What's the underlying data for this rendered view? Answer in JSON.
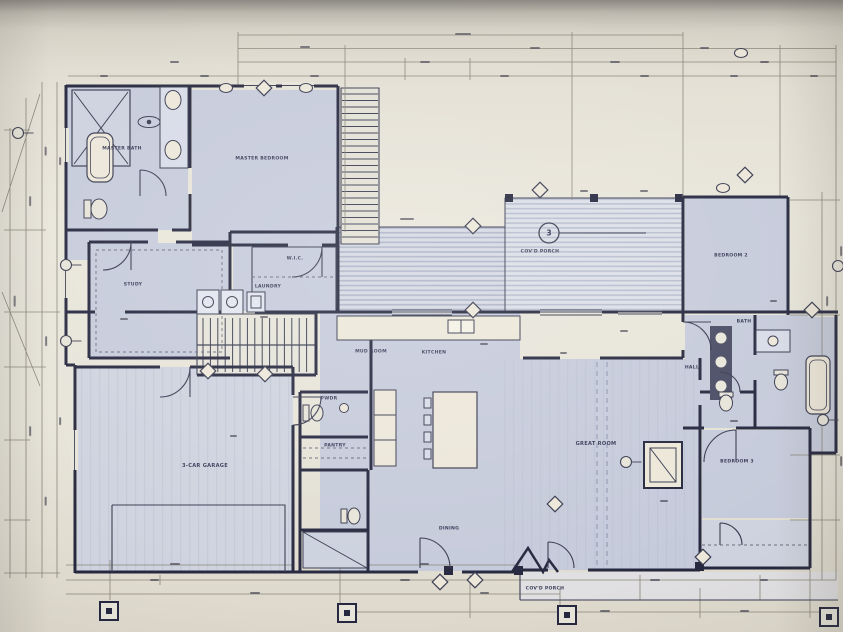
{
  "document": {
    "type": "architectural-first-floor-plan-photo",
    "description": "Photograph of a residential construction blueprint floor plan with dimension strings on all sides"
  },
  "rooms": {
    "master_bath": "MASTER BATH",
    "master_bedroom": "MASTER BEDROOM",
    "study": "STUDY",
    "laundry": "LAUNDRY",
    "mud_room": "MUD ROOM",
    "kitchen": "KITCHEN",
    "pantry": "PANTRY",
    "powder": "PWDR",
    "dining": "DINING",
    "great_room": "GREAT ROOM",
    "garage": "3-CAR GARAGE",
    "bedroom_2": "BEDROOM 2",
    "bedroom_3": "BEDROOM 3",
    "bath": "BATH",
    "hall": "HALL",
    "wic": "W.I.C.",
    "covered_porch_upper": "COV'D PORCH",
    "covered_porch_lower": "COV'D PORCH"
  },
  "markers": {
    "detail_number": "3"
  },
  "colors": {
    "wall": "#262840",
    "ink": "#3a3d52",
    "pen": "#8b867a",
    "room_fill": "#c6cbdc",
    "room_fill_alt": "#ced3e0",
    "paper": "#e7e4d9",
    "cream": "#ece7d8",
    "hatch_stripe": "#a9b1c6",
    "hatch_bg": "#d6d9e3",
    "beam": "#8a93ad",
    "label": "#2e3150"
  }
}
